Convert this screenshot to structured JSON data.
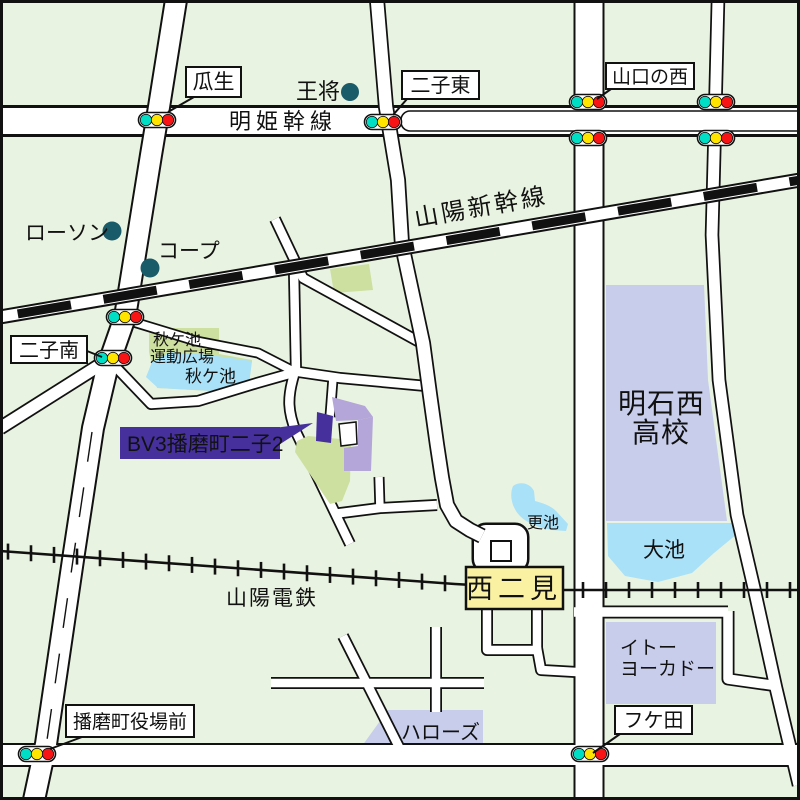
{
  "labels": {
    "uryu": "瓜生",
    "osho": "王将",
    "futago_higashi": "二子東",
    "yamaguchi_no_nishi": "山口の西",
    "meiki_kansen": "明姫幹線",
    "lawson": "ローソン",
    "coop": "コープ",
    "sanyo_shinkansen": "山陽新幹線",
    "futago_minami": "二子南",
    "park_line1": "秋ケ池",
    "park_line2": "運動広場",
    "akigaike_pond": "秋ケ池",
    "site_label": "BV3播磨町二子2",
    "school_line1": "明石西",
    "school_line2": "高校",
    "sarike_pond": "更池",
    "oike_pond": "大池",
    "sanyo_dentetsu": "山陽電鉄",
    "nishi_futami_station": "西二見",
    "itoyokado_line1": "イトー",
    "itoyokado_line2": "ヨーカドー",
    "hellos": "ハローズ",
    "fukeda": "フケ田",
    "yakuba_mae": "播磨町役場前"
  },
  "signals": {
    "lamp_colors": [
      "#00dfc6",
      "#ffe400",
      "#f81414"
    ],
    "positions": [
      {
        "name": "uryu-signal",
        "x": 157,
        "y": 120
      },
      {
        "name": "futago-higashi-signal",
        "x": 383,
        "y": 122
      },
      {
        "name": "yamaguchi-west-north-signal",
        "x": 588,
        "y": 102
      },
      {
        "name": "yamaguchi-west-south-signal",
        "x": 588,
        "y": 138
      },
      {
        "name": "east-crossing-north-signal",
        "x": 716,
        "y": 102
      },
      {
        "name": "east-crossing-south-signal",
        "x": 716,
        "y": 138
      },
      {
        "name": "shinkansen-crossing-signal",
        "x": 125,
        "y": 317
      },
      {
        "name": "futago-minami-signal",
        "x": 113,
        "y": 358
      },
      {
        "name": "yakuba-mae-signal",
        "x": 37,
        "y": 754
      },
      {
        "name": "fukeda-signal",
        "x": 590,
        "y": 754
      }
    ]
  },
  "colors": {
    "background": "#e9f3e1",
    "road_fill": "#ffffff",
    "road_casing": "#111111",
    "pond_blue": "#a9e1f8",
    "park_green": "#cde09f",
    "block_lavender": "#c7cdeb",
    "station_yellow": "#faf2a2",
    "site_purple": "#45309c",
    "site_light_purple": "#b4a6d8",
    "signal_teal": "#00dfc6",
    "signal_yellow": "#ffe400",
    "signal_red": "#f81414",
    "landmark_dot_teal": "#1a5b69"
  },
  "railway": {
    "dentetsu_tick_spacing": 23
  }
}
